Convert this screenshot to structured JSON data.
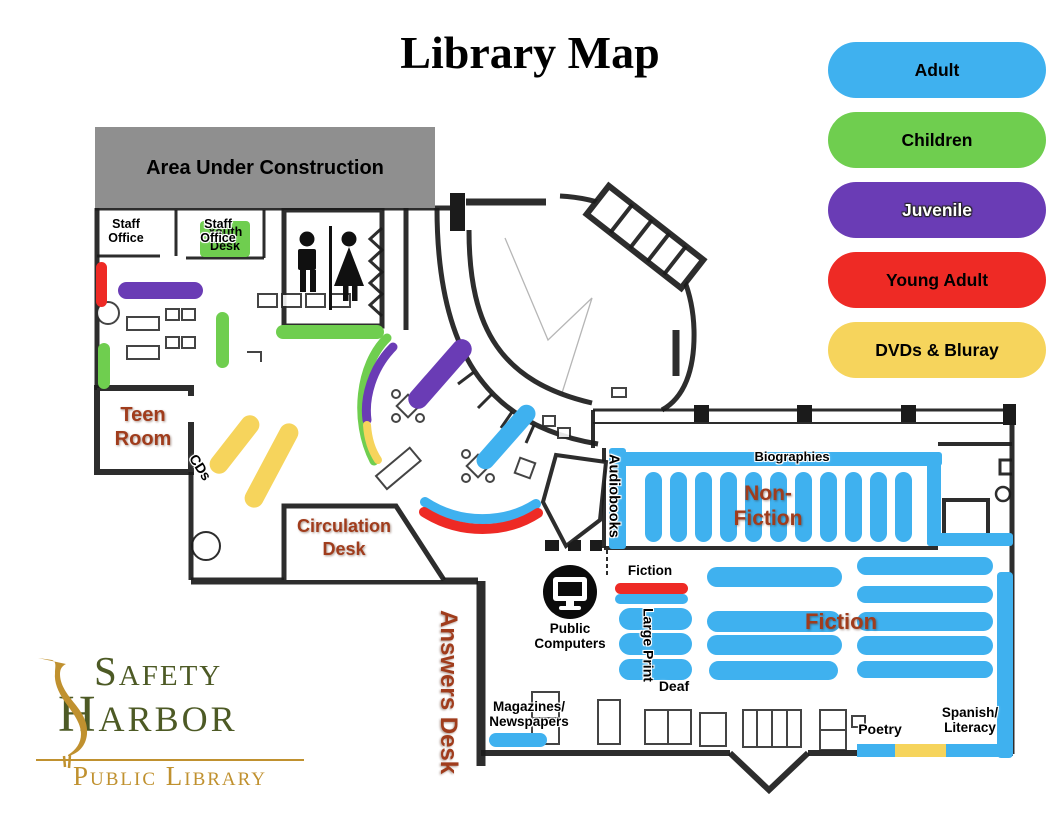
{
  "title": "Library Map",
  "legend": {
    "items": [
      {
        "label": "Adult"
      },
      {
        "label": "Children"
      },
      {
        "label": "Juvenile"
      },
      {
        "label": "Young Adult"
      },
      {
        "label": "DVDs & Bluray"
      }
    ]
  },
  "areas": {
    "construction": "Area Under Construction",
    "staff_office_1": "Staff Office",
    "staff_office_2": "Staff Office",
    "youth_desk": "Youth Desk",
    "teen_room": "Teen Room",
    "cds": "CDs",
    "circulation_desk": "Circulation Desk",
    "answers_desk": "Answers Desk",
    "public_computers": "Public Computers",
    "magazines_l1": "Magazines/",
    "magazines_l2": "Newspapers",
    "biographies": "Biographies",
    "audiobooks": "Audiobooks",
    "non_fiction_l1": "Non-",
    "non_fiction_l2": "Fiction",
    "fiction_section": "Fiction",
    "large_print": "Large Print",
    "deaf": "Deaf",
    "fiction_room": "Fiction",
    "poetry": "Poetry",
    "spanish_l1": "Spanish/",
    "spanish_l2": "Literacy"
  },
  "logo": {
    "name_top": "Safety",
    "name_bottom": "Harbor",
    "subtitle": "Public Library"
  },
  "colors": {
    "adult": "#3FB1EF",
    "children": "#6FCE4F",
    "juvenile": "#6A3CB5",
    "young_adult": "#EE2A25",
    "dvd": "#F6D45C",
    "brown": "#A03C1C",
    "gray": "#8F8F8F",
    "logo_green": "#4D5A25",
    "logo_gold": "#C0912F"
  }
}
